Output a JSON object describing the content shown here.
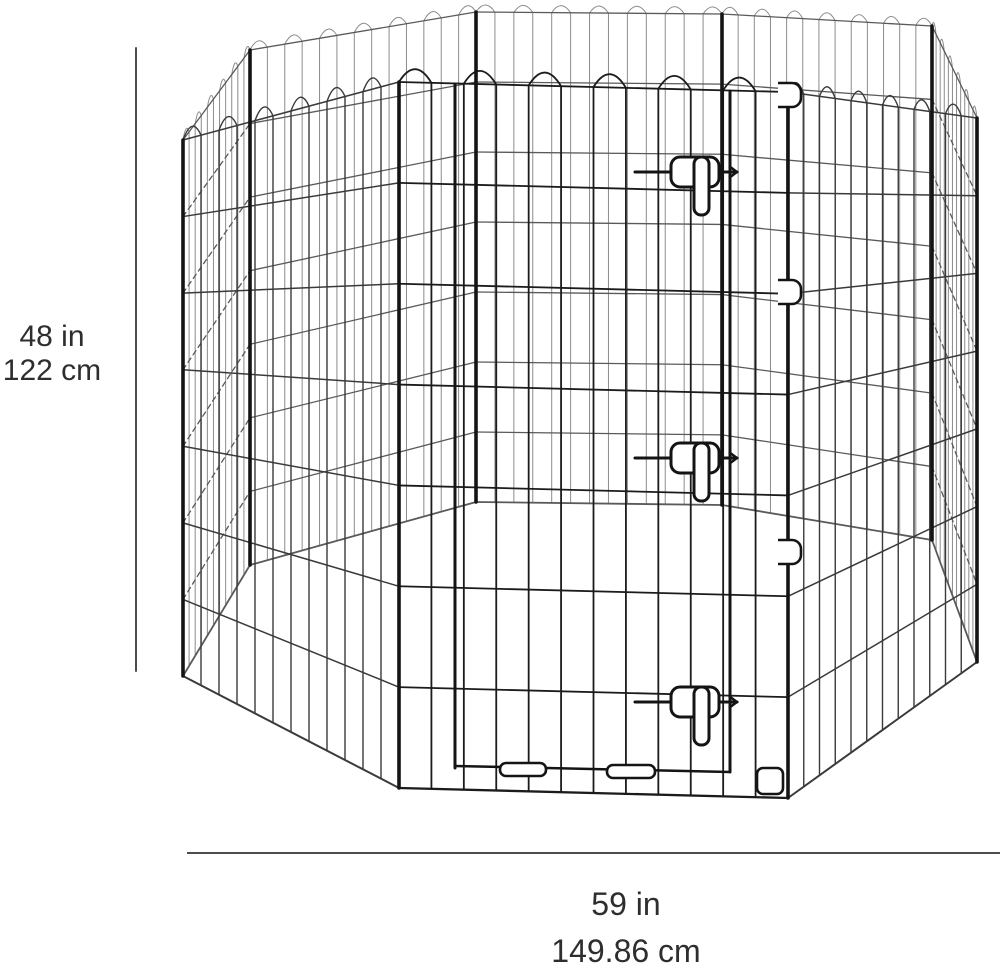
{
  "figure": {
    "title": "octagonal wire pet exercise pen dimension diagram",
    "background_color": "#ffffff",
    "colors": {
      "wire_dark": "#1b1b1b",
      "wire_near": "#3a3a3a",
      "wire_mid": "#5a5a5a",
      "wire_far": "#8c8c8c",
      "post": "#141414",
      "dimension_line": "#4d4d4d",
      "text": "#2e2e2e"
    }
  },
  "dimensions": {
    "height": {
      "imperial": "48 in",
      "metric": "122 cm"
    },
    "width": {
      "imperial": "59 in",
      "metric": "149.86 cm"
    }
  }
}
